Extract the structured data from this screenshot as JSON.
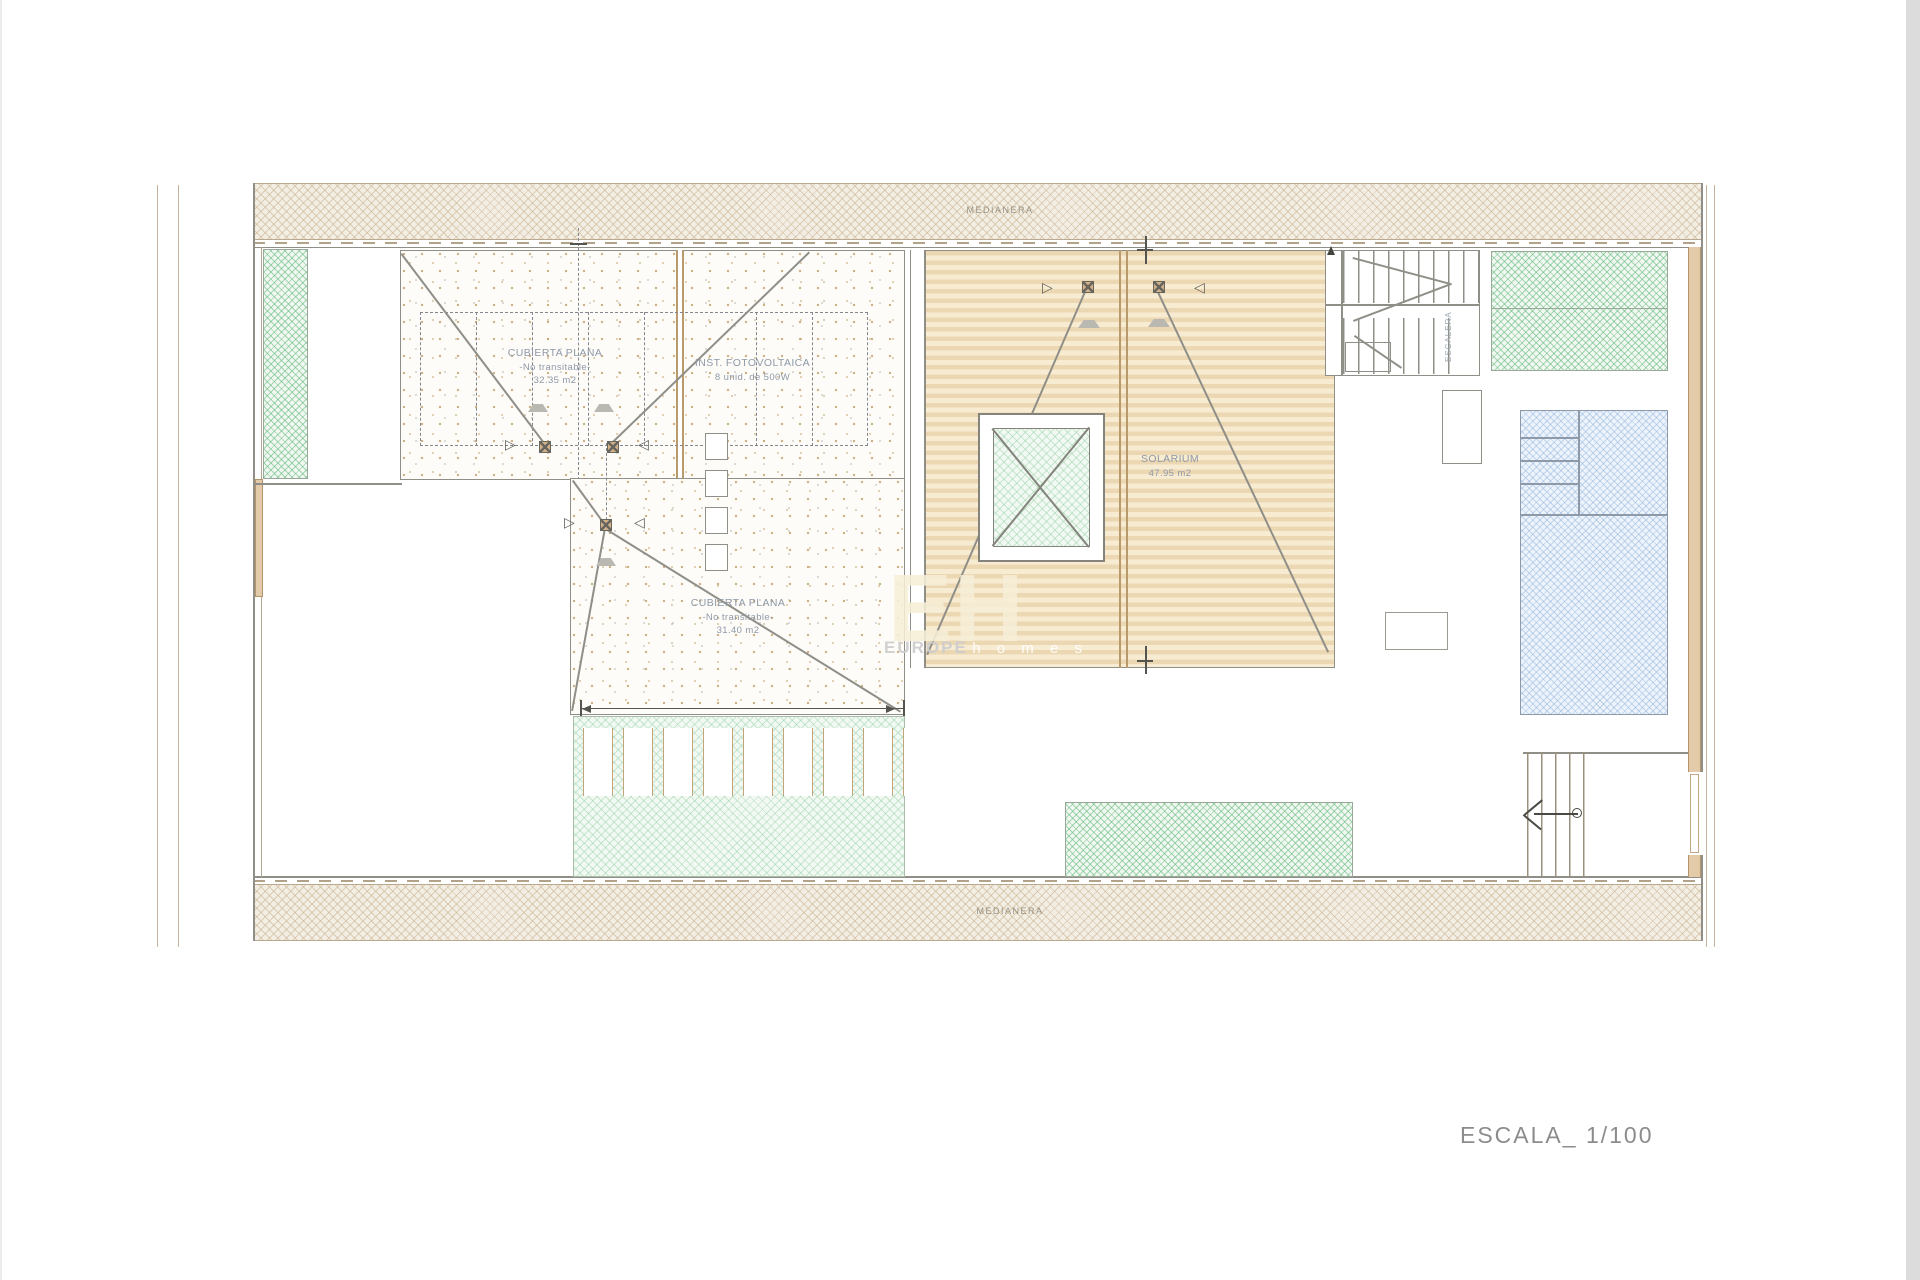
{
  "drawing": {
    "scale_label": "ESCALA_ 1/100",
    "top_party_wall": "MEDIANERA",
    "bottom_party_wall": "MEDIANERA",
    "flat_roof_1": {
      "title": "CUBIERTA PLANA",
      "subtitle": "-No transitable-",
      "area": "32.35 m2"
    },
    "pv_installation": {
      "title": "INST. FOTOVOLTAICA",
      "subtitle": "8 unid. de 500W"
    },
    "flat_roof_2": {
      "title": "CUBIERTA PLANA",
      "subtitle": "-No transitable-",
      "area": "31.40 m2"
    },
    "solarium": {
      "title": "SOLARIUM",
      "area": "47.95 m2"
    },
    "staircase_label": "ESCALERA",
    "watermark": {
      "logo": "EH",
      "brand_top": "EUROPE",
      "brand_bottom": "h o m e s"
    }
  },
  "colors": {
    "deck_wood": "#ecd7b3",
    "wall_hatch": "#c8b18e",
    "green_hatch": "#60b678",
    "pool_blue": "#7da5d7",
    "masonry_wall": "#e3cba9",
    "line_gray": "#8f8f88",
    "label_text": "#8e99a8",
    "scale_text": "#8c8c8c"
  }
}
